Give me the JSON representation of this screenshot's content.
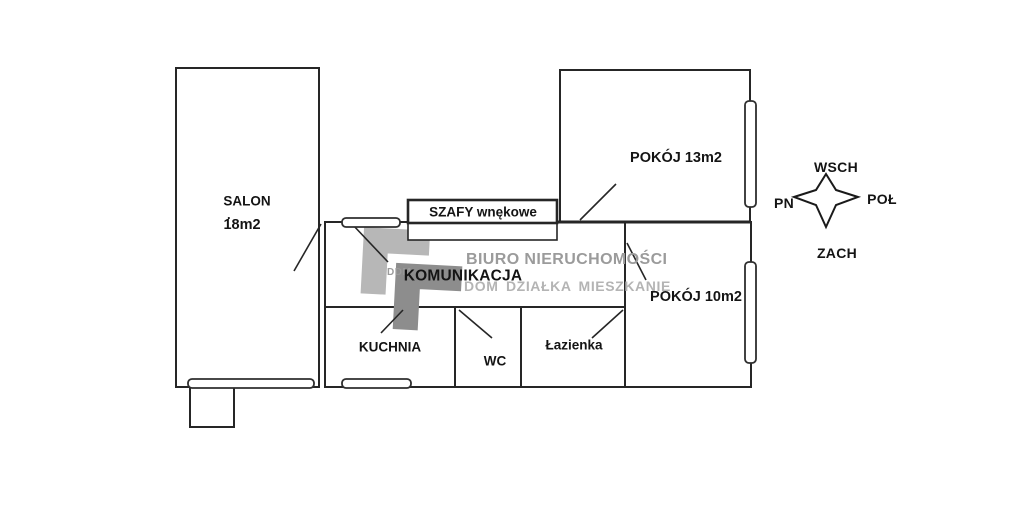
{
  "rooms": {
    "salon": {
      "name": "SALON",
      "area": "18m2",
      "dot": "."
    },
    "pokoj13": {
      "label": "POKÓJ 13m2"
    },
    "pokoj10": {
      "label": "POKÓJ 10m2"
    },
    "komunikacja": {
      "label": "KOMUNIKACJA"
    },
    "kuchnia": {
      "label": "KUCHNIA"
    },
    "wc": {
      "label": "WC"
    },
    "lazienka": {
      "label": "Łazienka"
    },
    "szafy": {
      "label": "SZAFY wnękowe"
    }
  },
  "compass": {
    "top": "WSCH",
    "left": "PN",
    "right": "POŁ",
    "bottom": "ZACH"
  },
  "watermark": {
    "logo_text": "DDM",
    "line1": "BIURO NIERUCHOMOŚCI",
    "line2": "DOM DZIAŁKA MIESZKANIE"
  },
  "colors": {
    "wall": "#262626",
    "watermark_light": "#b7b7b7",
    "watermark_dark": "#8d8d8d",
    "watermark_text_primary": "#9b9b9b",
    "watermark_text_secondary": "#b4b4b4"
  }
}
